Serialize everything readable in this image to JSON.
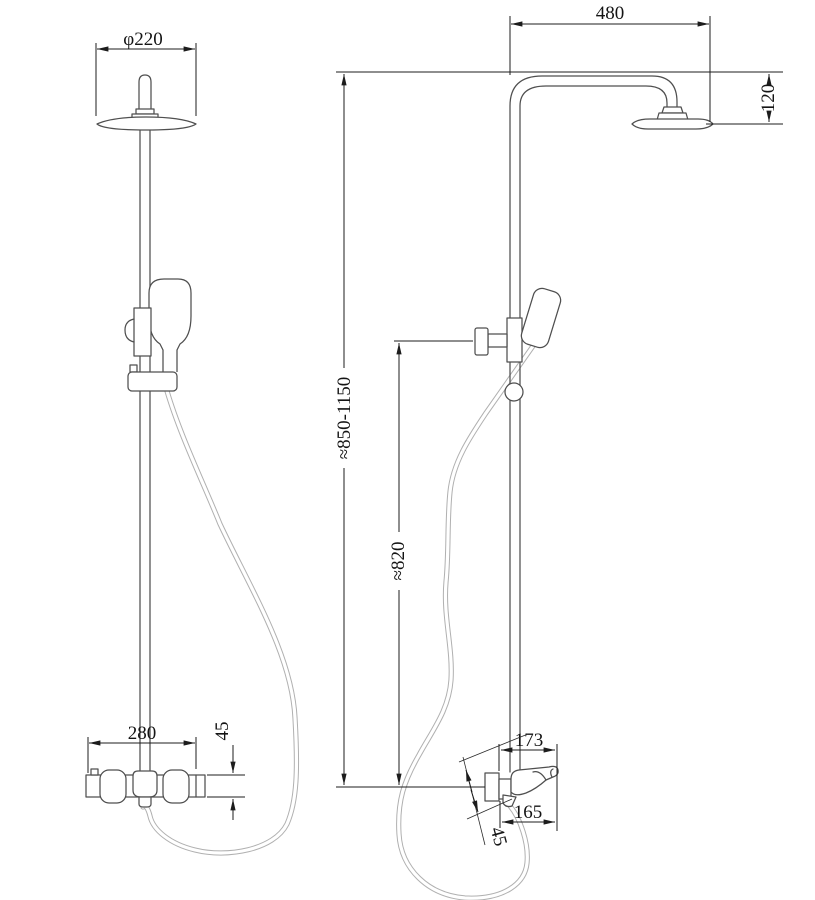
{
  "colors": {
    "background": "#ffffff",
    "object_line": "#4f4f4f",
    "dimension_line": "#1c1c1c",
    "hose_line": "#b0b0b0"
  },
  "dims": {
    "head_diameter": "φ220",
    "arm_reach": "480",
    "head_drop": "120",
    "overall_height": "≈850-1150",
    "hand_shower_height": "≈820",
    "valve_width": "280",
    "valve_height": "45",
    "valve_reach_top": "173",
    "valve_reach_bottom": "165",
    "outlet_offset": "45"
  }
}
